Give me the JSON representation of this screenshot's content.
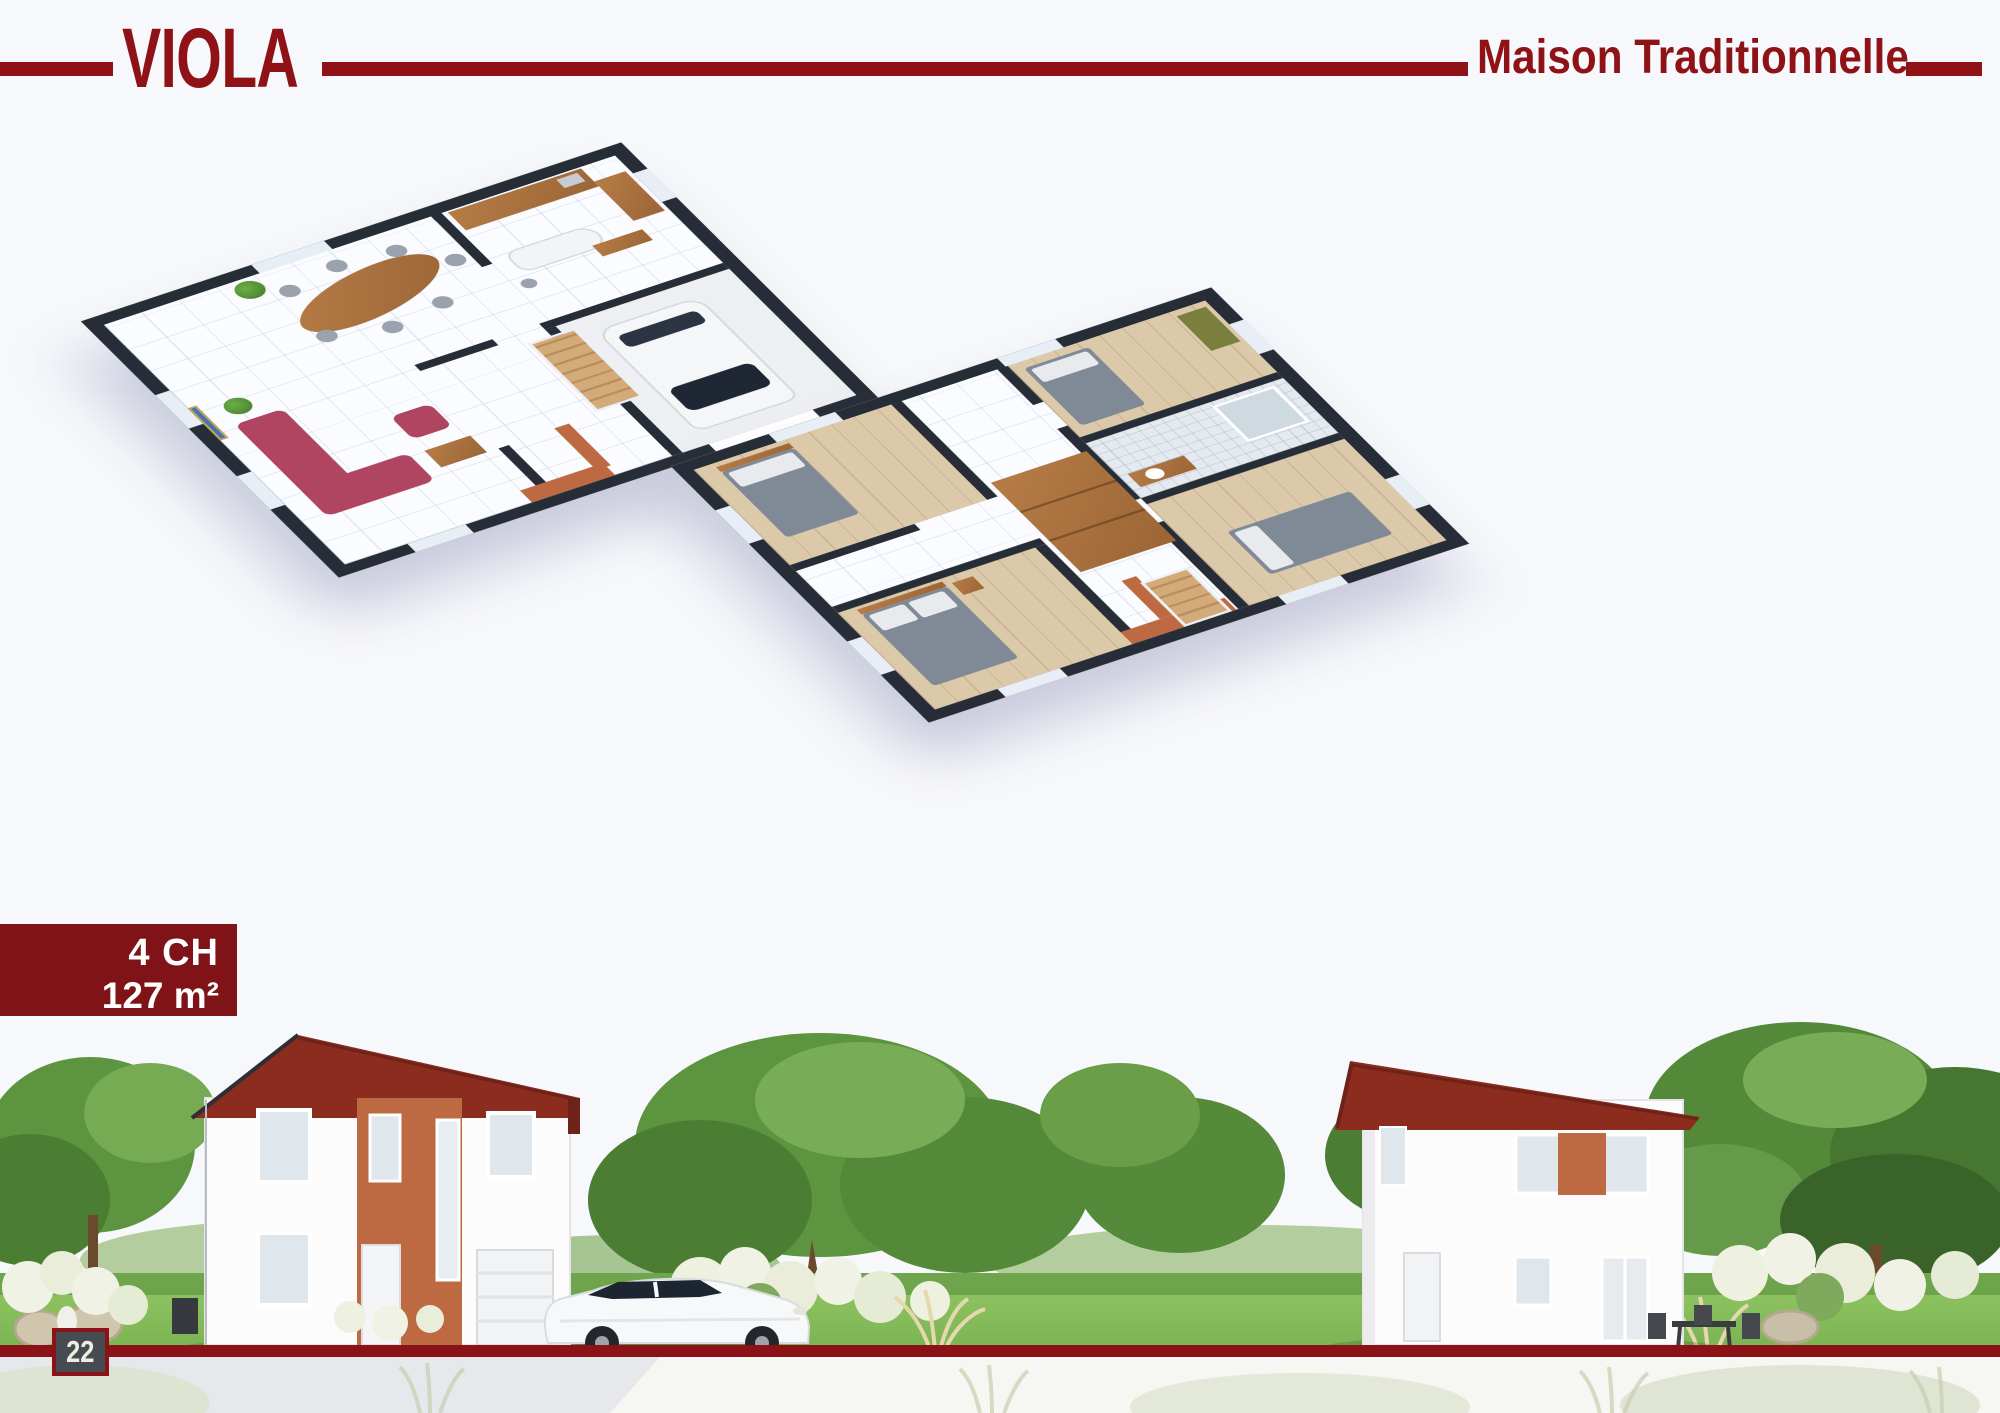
{
  "header": {
    "title": "VIOLA",
    "subtitle": "Maison Traditionnelle"
  },
  "spec_badge": {
    "bedrooms": "4 CH",
    "area": "127 m²"
  },
  "footer": {
    "page_number": "22"
  },
  "floorplans": {
    "ground": {
      "label": "Ground floor 3D cutaway plan: living room with raspberry sofa, dining table with chairs, kitchen with curved island, staircase, terracotta entrance walls, garage with white car"
    },
    "upper": {
      "label": "Upper floor 3D cutaway plan: four bedrooms with grey beds, wooden wardrobes, tiled bathroom with shower, staircase, terracotta accent walls"
    }
  },
  "exterior": {
    "label": "Street rendering of the Viola two-storey house, front and rear views, white walls, red tile roof, terracotta entrance strip, white compact car, garden trees and white flowering shrubs"
  },
  "colors": {
    "accent_red": "#8e1216",
    "band_red": "#8b1216",
    "badge_red": "#801318",
    "wall_dark": "#272d36",
    "terracotta": "#bd6a42",
    "roof_red": "#8c2c1e",
    "sofa_pink": "#b04561",
    "wood": "#a9713d",
    "grass_green": "#6fae47",
    "tree_green": "#55893a",
    "page_background": "#f7f8fb"
  }
}
